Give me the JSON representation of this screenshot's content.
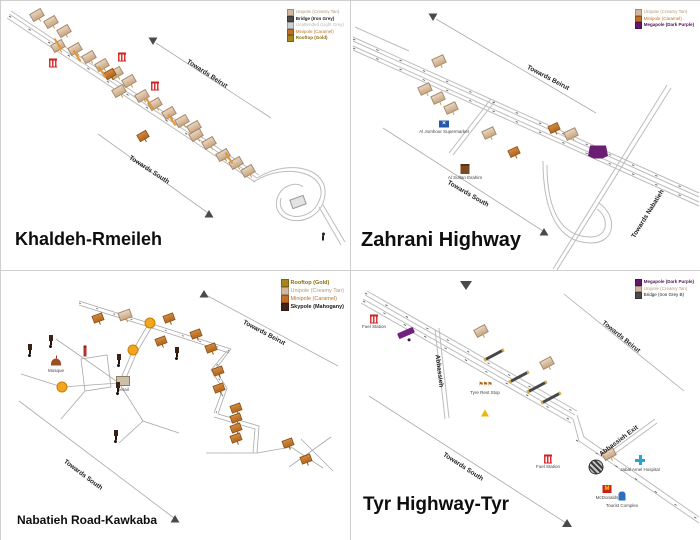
{
  "panels": [
    {
      "title": "Khaldeh-Rmeileh",
      "legend": [
        {
          "label": "Unipole (Creamy Tan)",
          "swatch": "#d3b89d",
          "color": "#b49878",
          "bold": false
        },
        {
          "label": "Bridge (Iron Grey)",
          "swatch": "#4a4a4a",
          "color": "#222222",
          "bold": true
        },
        {
          "label": "Unattended (Light Grey)",
          "swatch": "#cfcfcf",
          "color": "#b8b8b8",
          "bold": false
        },
        {
          "label": "Minipole (Caramel)",
          "swatch": "#c07020",
          "color": "#bf7326",
          "bold": false
        },
        {
          "label": "Rooftop (Gold)",
          "swatch": "#a5851c",
          "color": "#8a6d14",
          "bold": true
        }
      ],
      "directions": [
        {
          "text": "Towards Beirut",
          "x": 206,
          "y": 73,
          "r": 33
        },
        {
          "text": "Towards South",
          "x": 148,
          "y": 169,
          "r": 33
        }
      ],
      "markers": [
        {
          "type": "unipole",
          "x": 36,
          "y": 14
        },
        {
          "type": "unipole",
          "x": 50,
          "y": 21
        },
        {
          "type": "unipole",
          "x": 63,
          "y": 30
        },
        {
          "type": "unipole",
          "x": 57,
          "y": 45
        },
        {
          "type": "unipole",
          "x": 74,
          "y": 48
        },
        {
          "type": "unipole",
          "x": 88,
          "y": 56
        },
        {
          "type": "unipole",
          "x": 101,
          "y": 64
        },
        {
          "type": "unipole",
          "x": 115,
          "y": 72
        },
        {
          "type": "unipole",
          "x": 128,
          "y": 80
        },
        {
          "type": "unipole",
          "x": 118,
          "y": 90
        },
        {
          "type": "unipole",
          "x": 141,
          "y": 95
        },
        {
          "type": "unipole",
          "x": 154,
          "y": 103
        },
        {
          "type": "unipole",
          "x": 168,
          "y": 112
        },
        {
          "type": "unipole",
          "x": 181,
          "y": 120
        },
        {
          "type": "unipole",
          "x": 193,
          "y": 126
        },
        {
          "type": "unipole",
          "x": 195,
          "y": 134
        },
        {
          "type": "unipole",
          "x": 208,
          "y": 142
        },
        {
          "type": "unipole",
          "x": 222,
          "y": 154
        },
        {
          "type": "unipole",
          "x": 235,
          "y": 162
        },
        {
          "type": "unipole",
          "x": 247,
          "y": 170
        },
        {
          "type": "station",
          "x": 52,
          "y": 62
        },
        {
          "type": "station",
          "x": 121,
          "y": 56
        },
        {
          "type": "station",
          "x": 154,
          "y": 85
        },
        {
          "type": "minipole",
          "x": 109,
          "y": 73
        },
        {
          "type": "minipole",
          "x": 142,
          "y": 135
        },
        {
          "type": "overpass",
          "x": 57,
          "y": 43
        },
        {
          "type": "overpass",
          "x": 76,
          "y": 55
        },
        {
          "type": "overpass",
          "x": 101,
          "y": 71
        },
        {
          "type": "overpass",
          "x": 149,
          "y": 103
        },
        {
          "type": "overpass",
          "x": 171,
          "y": 119
        },
        {
          "type": "overpass",
          "x": 228,
          "y": 157
        },
        {
          "type": "building",
          "x": 297,
          "y": 201,
          "r": -20
        },
        {
          "type": "person",
          "x": 322,
          "y": 237
        }
      ]
    },
    {
      "title": "Zahrani Highway",
      "legend": [
        {
          "label": "Unipole (Creamy Tan)",
          "swatch": "#d3b89d",
          "color": "#b49878",
          "bold": false
        },
        {
          "label": "Minipole (Caramel)",
          "swatch": "#c07020",
          "color": "#bf7326",
          "bold": false
        },
        {
          "label": "Megapole (Dark Purple)",
          "swatch": "#65176e",
          "color": "#4a1152",
          "bold": true
        }
      ],
      "directions": [
        {
          "text": "Towards Beirut",
          "x": 197,
          "y": 77,
          "r": 28
        },
        {
          "text": "Towards South",
          "x": 117,
          "y": 193,
          "r": 30
        },
        {
          "text": "Towards Nabatieh",
          "x": 297,
          "y": 213,
          "r": -58
        }
      ],
      "markers": [
        {
          "type": "unipole",
          "x": 88,
          "y": 60,
          "r": -25
        },
        {
          "type": "unipole",
          "x": 74,
          "y": 88,
          "r": -25
        },
        {
          "type": "unipole",
          "x": 87,
          "y": 97,
          "r": -25
        },
        {
          "type": "unipole",
          "x": 100,
          "y": 107,
          "r": -25
        },
        {
          "type": "unipole",
          "x": 138,
          "y": 132,
          "r": -25
        },
        {
          "type": "unipole",
          "x": 220,
          "y": 133,
          "r": -25
        },
        {
          "type": "minipole",
          "x": 203,
          "y": 127,
          "r": -25
        },
        {
          "type": "minipole",
          "x": 163,
          "y": 151,
          "r": -25
        },
        {
          "type": "megapole",
          "x": 247,
          "y": 151
        },
        {
          "type": "supermarket",
          "x": 93,
          "y": 123,
          "glyph": "✕",
          "label": "Al Jomhour Supermarket",
          "ly": 5
        },
        {
          "type": "shop",
          "x": 114,
          "y": 168,
          "label": "Al Sultan Ibrahim",
          "ly": 6
        }
      ]
    },
    {
      "title": "Nabatieh Road-Kawkaba",
      "legend": [
        {
          "label": "Rooftop (Gold)",
          "swatch": "#a5851c",
          "color": "#8a6d14",
          "bold": true
        },
        {
          "label": "Unipole (Creamy Tan)",
          "swatch": "#d3b89d",
          "color": "#b49878",
          "bold": false
        },
        {
          "label": "Minipole (Caramel)",
          "swatch": "#c07020",
          "color": "#bf7326",
          "bold": false
        },
        {
          "label": "Skypole (Mahogany)",
          "swatch": "#40231a",
          "color": "#1a1a1a",
          "bold": true
        }
      ],
      "directions": [
        {
          "text": "Towards Beirut",
          "x": 263,
          "y": 62,
          "r": 28
        },
        {
          "text": "Towards South",
          "x": 82,
          "y": 204,
          "r": 37
        }
      ],
      "markers": [
        {
          "type": "roundabout-orange",
          "x": 149,
          "y": 52
        },
        {
          "type": "roundabout-orange",
          "x": 132,
          "y": 79
        },
        {
          "type": "roundabout-orange",
          "x": 61,
          "y": 116
        },
        {
          "type": "mosque",
          "x": 55,
          "y": 91,
          "label": "Mosque",
          "ly": 6
        },
        {
          "type": "minaret",
          "x": 84,
          "y": 80
        },
        {
          "type": "serail",
          "x": 122,
          "y": 110,
          "label": "Serail",
          "ly": 6
        },
        {
          "type": "skypole",
          "x": 50,
          "y": 67
        },
        {
          "type": "skypole",
          "x": 29,
          "y": 76
        },
        {
          "type": "skypole",
          "x": 118,
          "y": 86
        },
        {
          "type": "skypole",
          "x": 176,
          "y": 79
        },
        {
          "type": "skypole",
          "x": 117,
          "y": 114
        },
        {
          "type": "skypole",
          "x": 115,
          "y": 162
        },
        {
          "type": "unipole",
          "x": 124,
          "y": 44,
          "r": -20
        },
        {
          "type": "minipole",
          "x": 97,
          "y": 47,
          "r": -20
        },
        {
          "type": "minipole",
          "x": 168,
          "y": 47,
          "r": -20
        },
        {
          "type": "minipole",
          "x": 195,
          "y": 63,
          "r": -20
        },
        {
          "type": "minipole",
          "x": 160,
          "y": 70,
          "r": -20
        },
        {
          "type": "minipole",
          "x": 210,
          "y": 77,
          "r": -20
        },
        {
          "type": "minipole",
          "x": 217,
          "y": 100,
          "r": -20
        },
        {
          "type": "minipole",
          "x": 218,
          "y": 117,
          "r": -20
        },
        {
          "type": "minipole",
          "x": 235,
          "y": 137,
          "r": -20
        },
        {
          "type": "minipole",
          "x": 235,
          "y": 147,
          "r": -20
        },
        {
          "type": "minipole",
          "x": 235,
          "y": 157,
          "r": -20
        },
        {
          "type": "minipole",
          "x": 235,
          "y": 167,
          "r": -20
        },
        {
          "type": "minipole",
          "x": 287,
          "y": 172,
          "r": -20
        },
        {
          "type": "minipole",
          "x": 305,
          "y": 188,
          "r": -20
        }
      ]
    },
    {
      "title": "Tyr Highway-Tyr",
      "legend": [
        {
          "label": "Megapole (Dark Purple)",
          "swatch": "#65176e",
          "color": "#4a1152",
          "bold": true
        },
        {
          "label": "Unipole (Creamy Tan)",
          "swatch": "#d3b89d",
          "color": "#b49878",
          "bold": false
        },
        {
          "label": "Bridge (Iron Grey B)",
          "swatch": "#4a4a4a",
          "color": "#222222",
          "bold": false
        }
      ],
      "directions": [
        {
          "text": "Towards Beirut",
          "x": 270,
          "y": 66,
          "r": 39
        },
        {
          "text": "Towards South",
          "x": 112,
          "y": 196,
          "r": 33
        },
        {
          "text": "Abbassieh",
          "x": 88,
          "y": 100,
          "r": 83
        },
        {
          "text": "Abbassieh Exit",
          "x": 268,
          "y": 170,
          "r": -37
        }
      ],
      "markers": [
        {
          "type": "station",
          "x": 23,
          "y": 48,
          "label": "Fuel Station",
          "ly": 5
        },
        {
          "type": "station",
          "x": 197,
          "y": 188,
          "label": "Fuel Station",
          "ly": 5
        },
        {
          "type": "megapole-h",
          "x": 55,
          "y": 62
        },
        {
          "type": "unipole",
          "x": 130,
          "y": 60,
          "r": -28
        },
        {
          "type": "unipole",
          "x": 196,
          "y": 92,
          "r": -28
        },
        {
          "type": "unipole",
          "x": 258,
          "y": 183,
          "r": -28
        },
        {
          "type": "bridge",
          "x": 143,
          "y": 84
        },
        {
          "type": "bridge",
          "x": 168,
          "y": 106
        },
        {
          "type": "bridge",
          "x": 186,
          "y": 116
        },
        {
          "type": "bridge",
          "x": 200,
          "y": 127
        },
        {
          "type": "flags",
          "x": 134,
          "y": 114,
          "glyph": "⚑⚑⚑",
          "label": "Tyre Rest Stop",
          "ly": 5
        },
        {
          "type": "warning",
          "x": 134,
          "y": 142
        },
        {
          "type": "roundabout-dark",
          "x": 245,
          "y": 196
        },
        {
          "type": "hospital",
          "x": 289,
          "y": 189,
          "label": "Jabal Amel Hospital",
          "ly": 7
        },
        {
          "type": "mcdonalds",
          "x": 256,
          "y": 218,
          "glyph": "M",
          "label": "McDonalds",
          "ly": 6
        },
        {
          "type": "tourist",
          "x": 271,
          "y": 225,
          "label": "Tourist Complex",
          "ly": 7
        }
      ]
    }
  ]
}
